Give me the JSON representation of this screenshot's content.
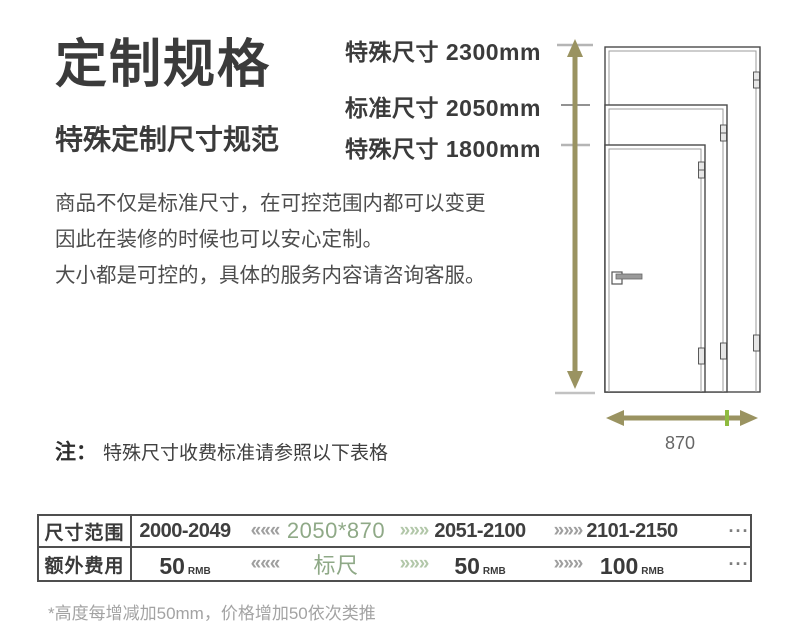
{
  "page": {
    "title": "定制规格",
    "subtitle": "特殊定制尺寸规范",
    "description_lines": [
      "商品不仅是标准尺寸，在可控范围内都可以变更",
      "因此在装修的时候也可以安心定制。",
      "大小都是可控的，具体的服务内容请咨询客服。"
    ],
    "note_prefix": "注：",
    "note_text": "特殊尺寸收费标准请参照以下表格",
    "footnote": "*高度每增减加50mm，价格增加50依次类推"
  },
  "diagram": {
    "height_labels": [
      {
        "text": "特殊尺寸 2300mm"
      },
      {
        "text": "标准尺寸 2050mm"
      },
      {
        "text": "特殊尺寸 1800mm"
      }
    ],
    "width_label": "870",
    "arrow_color": "#9a9361",
    "width_tick_color": "#8fbb3f",
    "accent_green": "#8fa987"
  },
  "table": {
    "row1": {
      "header": "尺寸范围",
      "range1": "2000-2049",
      "chevrons_left": "«««",
      "highlight": "2050*870",
      "chevrons_mid": "»»»",
      "range2": "2051-2100",
      "chevrons_right": "»»»",
      "range3": "2101-2150",
      "more": "···"
    },
    "row2": {
      "header": "额外费用",
      "fee1": {
        "value": "50",
        "unit": "RMB"
      },
      "chevrons_left": "«««",
      "highlight": "标尺",
      "chevrons_mid": "»»»",
      "fee2": {
        "value": "50",
        "unit": "RMB"
      },
      "chevrons_right": "»»»",
      "fee3": {
        "value": "100",
        "unit": "RMB"
      },
      "more": "···"
    }
  }
}
